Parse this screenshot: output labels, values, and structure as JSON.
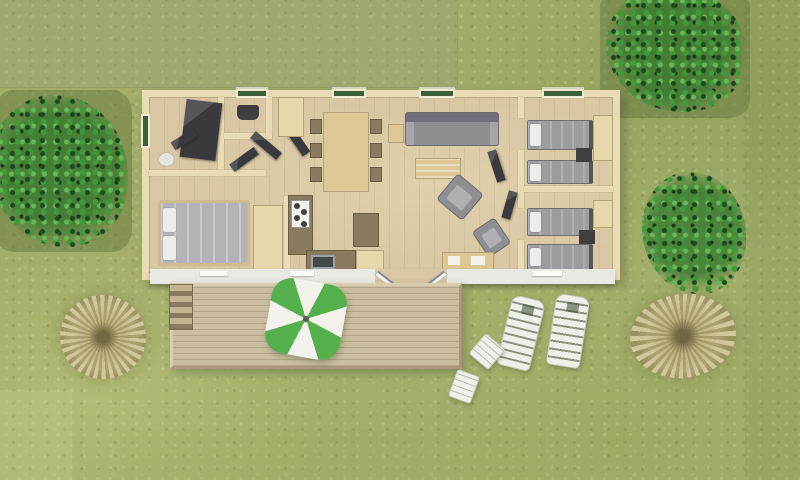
{
  "scene": {
    "type": "aerial-3d-floor-plan-render",
    "description": "Top-down 3D rendering of a mobile home / holiday cottage floor plan on a grass lot with trees, a wooden deck, a green-and-white parasol with chairs, and two white sun loungers"
  },
  "colors": {
    "grass_base": "#a2ad69",
    "tree_green": "#3f9a3a",
    "tree_dark": "#1c4a1c",
    "tree_light": "#67b757",
    "pampas_tan": "#d2c9a0",
    "wall": "#e9dcb4",
    "floor": "#d8c7a2",
    "deck": "#cbbda0",
    "deck_rim": "#d9cdb0",
    "white_wall": "#eae8e3",
    "window_green": "#3e5f3a",
    "window_frame": "#f0ead2",
    "sofa": "#8f8f93",
    "duvet": "#9c9ca1",
    "duvet_light": "#b4b4b8",
    "pillow": "#ececea",
    "dark_gray": "#3f3f42",
    "counter": "#8a7a5e",
    "cabinet": "#e6d8ab",
    "parasol_green": "#54b04c",
    "parasol_white": "#f3f2ed",
    "lounger": "#eff0e9"
  },
  "house": {
    "rooms": [
      "master-bedroom",
      "bathroom",
      "wc",
      "hallway",
      "kitchen",
      "dining-area",
      "living-area",
      "twin-bedroom-top",
      "twin-bedroom-bottom"
    ],
    "top_wall_windows": 4,
    "side_wall_windows": 1,
    "double_beds": 1,
    "single_beds": 4,
    "dining_chairs": 6
  },
  "outdoor": {
    "deck_material": "wood-planks",
    "deck_has_steps": true,
    "parasol_style": "green-white-pinwheel",
    "deck_chairs": 3,
    "sun_loungers": 2,
    "side_tables": 2,
    "green_trees": 3,
    "dry_grass_bushes": 2
  }
}
